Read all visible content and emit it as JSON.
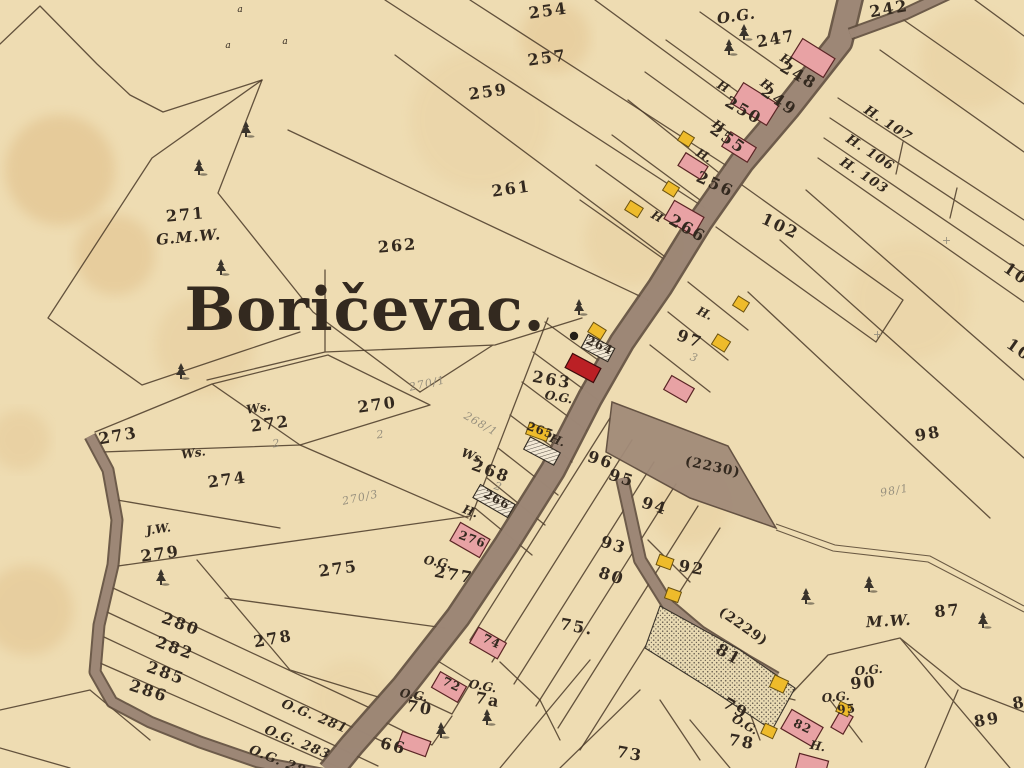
{
  "map": {
    "place_name": "Boričevac.",
    "colors": {
      "paper": "#eedcb2",
      "ink": "#33291f",
      "pencil": "#97907e",
      "boundary_line": "#4a3a28",
      "road_fill": "#a28b79",
      "road_edge": "#5e4c3e",
      "masonry_building": "#e8a2a4",
      "masonry_outline": "#5a2525",
      "church_building": "#bb2025",
      "wood_building": "#eebb2b",
      "wood_outline": "#6b5210",
      "stain": "#cf9a55"
    },
    "labels": [
      {
        "t": "Boričevac.",
        "x": 365,
        "y": 330,
        "r": 0,
        "c": "title"
      },
      {
        "t": "254",
        "x": 549,
        "y": 16,
        "r": -8,
        "c": "num"
      },
      {
        "t": "257",
        "x": 548,
        "y": 63,
        "r": -8,
        "c": "num"
      },
      {
        "t": "259",
        "x": 489,
        "y": 97,
        "r": -8,
        "c": "num"
      },
      {
        "t": "261",
        "x": 512,
        "y": 194,
        "r": -8,
        "c": "num"
      },
      {
        "t": "262",
        "x": 398,
        "y": 251,
        "r": -5,
        "c": "num"
      },
      {
        "t": "242",
        "x": 890,
        "y": 14,
        "r": -10,
        "c": "num"
      },
      {
        "t": "O.G.",
        "x": 737,
        "y": 21,
        "r": -8,
        "c": "it-lg"
      },
      {
        "t": "247",
        "x": 777,
        "y": 44,
        "r": -10,
        "c": "num"
      },
      {
        "t": "H.",
        "x": 786,
        "y": 64,
        "r": 30,
        "c": "it"
      },
      {
        "t": "248",
        "x": 796,
        "y": 80,
        "r": 30,
        "c": "num"
      },
      {
        "t": "H",
        "x": 764,
        "y": 88,
        "r": 35,
        "c": "it"
      },
      {
        "t": "249",
        "x": 776,
        "y": 105,
        "r": 35,
        "c": "num"
      },
      {
        "t": "H",
        "x": 721,
        "y": 90,
        "r": 30,
        "c": "it"
      },
      {
        "t": "250",
        "x": 741,
        "y": 115,
        "r": 30,
        "c": "num"
      },
      {
        "t": "H",
        "x": 716,
        "y": 129,
        "r": 35,
        "c": "it"
      },
      {
        "t": "255",
        "x": 725,
        "y": 143,
        "r": 35,
        "c": "num"
      },
      {
        "t": "H.",
        "x": 702,
        "y": 159,
        "r": 30,
        "c": "it"
      },
      {
        "t": "256",
        "x": 713,
        "y": 189,
        "r": 25,
        "c": "num"
      },
      {
        "t": "H",
        "x": 655,
        "y": 220,
        "r": 30,
        "c": "it"
      },
      {
        "t": "266",
        "x": 685,
        "y": 233,
        "r": 30,
        "c": "num"
      },
      {
        "t": "102",
        "x": 778,
        "y": 231,
        "r": 25,
        "c": "num"
      },
      {
        "t": "H. 107",
        "x": 886,
        "y": 127,
        "r": 33,
        "c": "hnum"
      },
      {
        "t": "H. 106",
        "x": 868,
        "y": 156,
        "r": 33,
        "c": "hnum"
      },
      {
        "t": "H. 103",
        "x": 862,
        "y": 179,
        "r": 33,
        "c": "hnum"
      },
      {
        "t": "10",
        "x": 1013,
        "y": 278,
        "r": 35,
        "c": "num"
      },
      {
        "t": "10",
        "x": 1016,
        "y": 354,
        "r": 35,
        "c": "num"
      },
      {
        "t": "H.",
        "x": 703,
        "y": 317,
        "r": 25,
        "c": "it"
      },
      {
        "t": "97",
        "x": 688,
        "y": 344,
        "r": 20,
        "c": "num"
      },
      {
        "t": "3",
        "x": 693,
        "y": 361,
        "r": 20,
        "c": "pencil"
      },
      {
        "t": "263",
        "x": 551,
        "y": 385,
        "r": 10,
        "c": "num"
      },
      {
        "t": "O.G.",
        "x": 558,
        "y": 401,
        "r": 10,
        "c": "it"
      },
      {
        "t": "264",
        "x": 598,
        "y": 349,
        "r": 25,
        "c": "num-s"
      },
      {
        "t": "265",
        "x": 539,
        "y": 434,
        "r": 20,
        "c": "num-s"
      },
      {
        "t": "H.",
        "x": 556,
        "y": 444,
        "r": 20,
        "c": "it"
      },
      {
        "t": "266",
        "x": 495,
        "y": 503,
        "r": 28,
        "c": "num-s"
      },
      {
        "t": "H.",
        "x": 469,
        "y": 515,
        "r": 20,
        "c": "it"
      },
      {
        "t": "276",
        "x": 471,
        "y": 543,
        "r": 20,
        "c": "num-s"
      },
      {
        "t": "O.G.",
        "x": 437,
        "y": 566,
        "r": 10,
        "c": "it"
      },
      {
        "t": "277",
        "x": 453,
        "y": 580,
        "r": 10,
        "c": "num"
      },
      {
        "t": "Ws.",
        "x": 472,
        "y": 460,
        "r": 20,
        "c": "it"
      },
      {
        "t": "268",
        "x": 489,
        "y": 476,
        "r": 20,
        "c": "num"
      },
      {
        "t": "2",
        "x": 497,
        "y": 490,
        "r": 20,
        "c": "pencil"
      },
      {
        "t": "268/1",
        "x": 479,
        "y": 427,
        "r": 30,
        "c": "pencil"
      },
      {
        "t": "270",
        "x": 378,
        "y": 410,
        "r": -8,
        "c": "num"
      },
      {
        "t": "2",
        "x": 381,
        "y": 438,
        "r": -8,
        "c": "pencil"
      },
      {
        "t": "270/1",
        "x": 428,
        "y": 387,
        "r": -12,
        "c": "pencil"
      },
      {
        "t": "270/3",
        "x": 361,
        "y": 501,
        "r": -12,
        "c": "pencil"
      },
      {
        "t": "Ws.",
        "x": 259,
        "y": 412,
        "r": -8,
        "c": "it"
      },
      {
        "t": "272",
        "x": 271,
        "y": 429,
        "r": -8,
        "c": "num"
      },
      {
        "t": "2",
        "x": 277,
        "y": 447,
        "r": -8,
        "c": "pencil"
      },
      {
        "t": "Ws.",
        "x": 194,
        "y": 457,
        "r": -8,
        "c": "it"
      },
      {
        "t": "274",
        "x": 228,
        "y": 485,
        "r": -8,
        "c": "num"
      },
      {
        "t": "273",
        "x": 119,
        "y": 441,
        "r": -10,
        "c": "num"
      },
      {
        "t": "271",
        "x": 186,
        "y": 220,
        "r": -5,
        "c": "num"
      },
      {
        "t": "G.M.W.",
        "x": 189,
        "y": 242,
        "r": -5,
        "c": "it-lg"
      },
      {
        "t": "J.W.",
        "x": 159,
        "y": 533,
        "r": -8,
        "c": "it"
      },
      {
        "t": "279",
        "x": 161,
        "y": 559,
        "r": -8,
        "c": "num"
      },
      {
        "t": "275",
        "x": 339,
        "y": 574,
        "r": -8,
        "c": "num"
      },
      {
        "t": "278",
        "x": 274,
        "y": 644,
        "r": -10,
        "c": "num"
      },
      {
        "t": "280",
        "x": 179,
        "y": 629,
        "r": 20,
        "c": "num"
      },
      {
        "t": "282",
        "x": 173,
        "y": 653,
        "r": 20,
        "c": "num"
      },
      {
        "t": "285",
        "x": 164,
        "y": 678,
        "r": 20,
        "c": "num"
      },
      {
        "t": "286",
        "x": 147,
        "y": 696,
        "r": 18,
        "c": "num"
      },
      {
        "t": "O.G. 281",
        "x": 313,
        "y": 720,
        "r": 22,
        "c": "hnum"
      },
      {
        "t": "O.G. 283",
        "x": 296,
        "y": 746,
        "r": 22,
        "c": "hnum"
      },
      {
        "t": "O.G. 28",
        "x": 276,
        "y": 764,
        "r": 22,
        "c": "hnum"
      },
      {
        "t": "96",
        "x": 599,
        "y": 465,
        "r": 18,
        "c": "num"
      },
      {
        "t": "95",
        "x": 620,
        "y": 483,
        "r": 18,
        "c": "num"
      },
      {
        "t": "94",
        "x": 653,
        "y": 511,
        "r": 18,
        "c": "num"
      },
      {
        "t": "93",
        "x": 612,
        "y": 550,
        "r": 18,
        "c": "num"
      },
      {
        "t": "92",
        "x": 691,
        "y": 573,
        "r": 10,
        "c": "num"
      },
      {
        "t": "80",
        "x": 610,
        "y": 581,
        "r": 18,
        "c": "num"
      },
      {
        "t": "75.",
        "x": 576,
        "y": 632,
        "r": 10,
        "c": "num"
      },
      {
        "t": "(2230)",
        "x": 712,
        "y": 471,
        "r": 12,
        "c": "roadnum"
      },
      {
        "t": "(2229)",
        "x": 741,
        "y": 630,
        "r": 35,
        "c": "roadnum"
      },
      {
        "t": "81",
        "x": 726,
        "y": 659,
        "r": 30,
        "c": "num"
      },
      {
        "t": "98",
        "x": 929,
        "y": 439,
        "r": -10,
        "c": "num"
      },
      {
        "t": "98/1",
        "x": 895,
        "y": 494,
        "r": -10,
        "c": "pencil"
      },
      {
        "t": "+",
        "x": 878,
        "y": 338,
        "r": 0,
        "c": "pencil"
      },
      {
        "t": "+",
        "x": 947,
        "y": 244,
        "r": 0,
        "c": "pencil"
      },
      {
        "t": "M.W.",
        "x": 889,
        "y": 626,
        "r": -3,
        "c": "it-lg"
      },
      {
        "t": "87",
        "x": 948,
        "y": 616,
        "r": -5,
        "c": "num"
      },
      {
        "t": "89",
        "x": 988,
        "y": 725,
        "r": -10,
        "c": "num"
      },
      {
        "t": "8",
        "x": 1020,
        "y": 708,
        "r": -10,
        "c": "num"
      },
      {
        "t": "O.G.",
        "x": 869,
        "y": 674,
        "r": -5,
        "c": "it"
      },
      {
        "t": "90",
        "x": 864,
        "y": 688,
        "r": -5,
        "c": "num"
      },
      {
        "t": "O.G.",
        "x": 836,
        "y": 701,
        "r": -5,
        "c": "it"
      },
      {
        "t": "95",
        "x": 847,
        "y": 713,
        "r": -5,
        "c": "num-s"
      },
      {
        "t": "82",
        "x": 801,
        "y": 730,
        "r": 25,
        "c": "num-s"
      },
      {
        "t": "H.",
        "x": 817,
        "y": 750,
        "r": 10,
        "c": "it"
      },
      {
        "t": "78",
        "x": 741,
        "y": 747,
        "r": 10,
        "c": "num"
      },
      {
        "t": "79",
        "x": 733,
        "y": 713,
        "r": 30,
        "c": "num"
      },
      {
        "t": "O.G.",
        "x": 743,
        "y": 728,
        "r": 30,
        "c": "it"
      },
      {
        "t": "73",
        "x": 629,
        "y": 759,
        "r": 10,
        "c": "num"
      },
      {
        "t": "66",
        "x": 392,
        "y": 751,
        "r": 15,
        "c": "num"
      },
      {
        "t": "O.G.",
        "x": 413,
        "y": 699,
        "r": 10,
        "c": "it"
      },
      {
        "t": "70",
        "x": 419,
        "y": 713,
        "r": 10,
        "c": "num"
      },
      {
        "t": "72",
        "x": 450,
        "y": 688,
        "r": 25,
        "c": "num-s"
      },
      {
        "t": "O.G.",
        "x": 482,
        "y": 690,
        "r": 10,
        "c": "it"
      },
      {
        "t": "7a",
        "x": 487,
        "y": 705,
        "r": 10,
        "c": "num"
      },
      {
        "t": "74",
        "x": 490,
        "y": 645,
        "r": 25,
        "c": "num-s"
      },
      {
        "t": "a",
        "x": 240,
        "y": 12,
        "r": 0,
        "c": "glyph"
      },
      {
        "t": "a",
        "x": 228,
        "y": 48,
        "r": 0,
        "c": "glyph"
      },
      {
        "t": "a",
        "x": 285,
        "y": 44,
        "r": 0,
        "c": "glyph"
      }
    ],
    "buildings": [
      {
        "type": "masonry",
        "x": 813,
        "y": 58,
        "w": 38,
        "h": 22,
        "r": 32
      },
      {
        "type": "masonry",
        "x": 755,
        "y": 104,
        "w": 42,
        "h": 24,
        "r": 32
      },
      {
        "type": "masonry",
        "x": 739,
        "y": 147,
        "w": 30,
        "h": 17,
        "r": 32
      },
      {
        "type": "masonry",
        "x": 693,
        "y": 166,
        "w": 26,
        "h": 15,
        "r": 32
      },
      {
        "type": "masonry",
        "x": 684,
        "y": 218,
        "w": 34,
        "h": 21,
        "r": 30
      },
      {
        "type": "masonry",
        "x": 679,
        "y": 389,
        "w": 26,
        "h": 16,
        "r": 30
      },
      {
        "type": "masonry",
        "x": 470,
        "y": 540,
        "w": 34,
        "h": 21,
        "r": 30
      },
      {
        "type": "masonry",
        "x": 488,
        "y": 643,
        "w": 32,
        "h": 18,
        "r": 30
      },
      {
        "type": "masonry",
        "x": 449,
        "y": 687,
        "w": 30,
        "h": 18,
        "r": 30
      },
      {
        "type": "masonry",
        "x": 414,
        "y": 744,
        "w": 30,
        "h": 16,
        "r": 20
      },
      {
        "type": "masonry",
        "x": 802,
        "y": 728,
        "w": 36,
        "h": 22,
        "r": 30
      },
      {
        "type": "masonry",
        "x": 842,
        "y": 722,
        "w": 14,
        "h": 20,
        "r": 30
      },
      {
        "type": "masonry",
        "x": 812,
        "y": 765,
        "w": 30,
        "h": 16,
        "r": 15
      },
      {
        "type": "church",
        "x": 583,
        "y": 368,
        "w": 32,
        "h": 16,
        "r": 28
      },
      {
        "type": "wood",
        "x": 686,
        "y": 139,
        "w": 13,
        "h": 11,
        "r": 32
      },
      {
        "type": "wood",
        "x": 671,
        "y": 189,
        "w": 13,
        "h": 11,
        "r": 32
      },
      {
        "type": "wood",
        "x": 634,
        "y": 209,
        "w": 15,
        "h": 11,
        "r": 32
      },
      {
        "type": "wood",
        "x": 741,
        "y": 304,
        "w": 13,
        "h": 11,
        "r": 32
      },
      {
        "type": "wood",
        "x": 721,
        "y": 343,
        "w": 15,
        "h": 12,
        "r": 32
      },
      {
        "type": "wood",
        "x": 597,
        "y": 331,
        "w": 15,
        "h": 11,
        "r": 32
      },
      {
        "type": "wood",
        "x": 665,
        "y": 562,
        "w": 15,
        "h": 11,
        "r": 20
      },
      {
        "type": "wood",
        "x": 673,
        "y": 595,
        "w": 14,
        "h": 11,
        "r": 20
      },
      {
        "type": "wood",
        "x": 779,
        "y": 684,
        "w": 15,
        "h": 13,
        "r": 25
      },
      {
        "type": "wood",
        "x": 769,
        "y": 731,
        "w": 13,
        "h": 11,
        "r": 25
      },
      {
        "type": "wood",
        "x": 844,
        "y": 709,
        "w": 13,
        "h": 11,
        "r": 25
      },
      {
        "type": "wood",
        "x": 538,
        "y": 432,
        "w": 22,
        "h": 12,
        "r": 20
      },
      {
        "type": "frame",
        "x": 598,
        "y": 348,
        "w": 30,
        "h": 15,
        "r": 28
      },
      {
        "type": "frame",
        "x": 542,
        "y": 451,
        "w": 34,
        "h": 14,
        "r": 28
      },
      {
        "type": "frame",
        "x": 494,
        "y": 501,
        "w": 40,
        "h": 15,
        "r": 30
      }
    ],
    "trees": [
      [
        246,
        130
      ],
      [
        199,
        168
      ],
      [
        221,
        268
      ],
      [
        181,
        372
      ],
      [
        161,
        578
      ],
      [
        744,
        33
      ],
      [
        729,
        48
      ],
      [
        579,
        308
      ],
      [
        806,
        597
      ],
      [
        869,
        585
      ],
      [
        983,
        621
      ],
      [
        441,
        731
      ],
      [
        487,
        718
      ]
    ],
    "dots": [
      [
        574,
        336
      ]
    ],
    "stains": [
      [
        60,
        170,
        55,
        0.25
      ],
      [
        115,
        255,
        40,
        0.22
      ],
      [
        28,
        610,
        45,
        0.2
      ],
      [
        555,
        38,
        35,
        0.18
      ],
      [
        205,
        345,
        50,
        0.12
      ],
      [
        690,
        505,
        40,
        0.1
      ],
      [
        910,
        300,
        60,
        0.08
      ],
      [
        480,
        120,
        70,
        0.08
      ],
      [
        20,
        440,
        30,
        0.15
      ],
      [
        970,
        60,
        50,
        0.1
      ],
      [
        350,
        700,
        40,
        0.08
      ],
      [
        630,
        240,
        45,
        0.1
      ]
    ]
  }
}
